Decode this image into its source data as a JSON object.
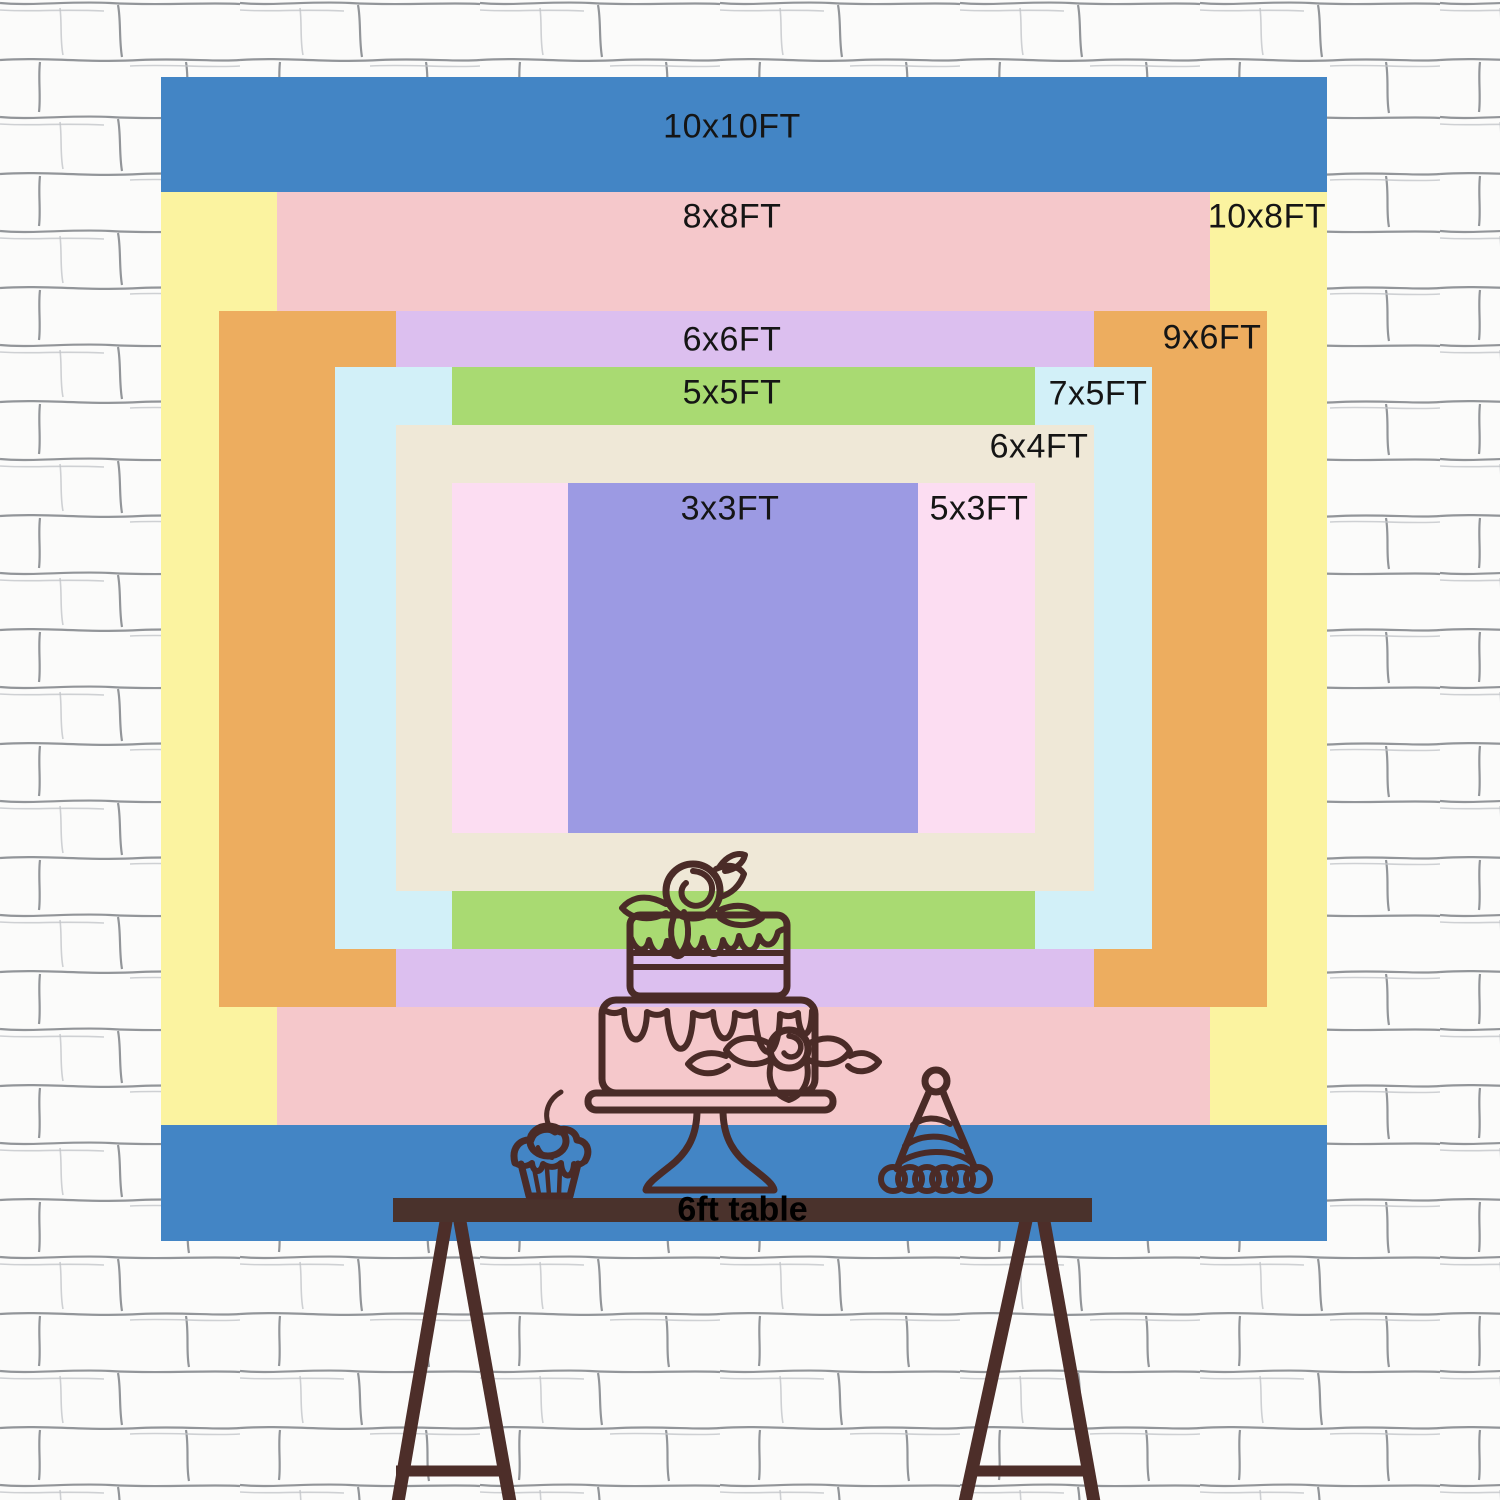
{
  "wall": {
    "bg_color": "#fbfbfa",
    "brick_line_color": "#6e7278",
    "brick_line_faint_color": "#c3c5c9"
  },
  "sizes": [
    {
      "id": "10x10ft",
      "label": "10x10FT",
      "color": "#4385C5",
      "rect": [
        161,
        77,
        1166,
        1164
      ],
      "label_pos": [
        732,
        127
      ]
    },
    {
      "id": "10x8ft",
      "label": "10x8FT",
      "color": "#FBF3A0",
      "rect": [
        161,
        192,
        1166,
        933
      ],
      "label_pos": [
        1267,
        217
      ]
    },
    {
      "id": "8x8ft",
      "label": "8x8FT",
      "color": "#F5C8CB",
      "rect": [
        277,
        192,
        933,
        933
      ],
      "label_pos": [
        732,
        217
      ]
    },
    {
      "id": "9x6ft",
      "label": "9x6FT",
      "color": "#EDAD5F",
      "rect": [
        219,
        311,
        1048,
        696
      ],
      "label_pos": [
        1212,
        338
      ]
    },
    {
      "id": "6x6ft",
      "label": "6x6FT",
      "color": "#DCBFEF",
      "rect": [
        396,
        311,
        698,
        696
      ],
      "label_pos": [
        732,
        340
      ]
    },
    {
      "id": "7x5ft",
      "label": "7x5FT",
      "color": "#D2F0F8",
      "rect": [
        335,
        367,
        817,
        582
      ],
      "label_pos": [
        1098,
        394
      ]
    },
    {
      "id": "5x5ft",
      "label": "5x5FT",
      "color": "#A9DA72",
      "rect": [
        452,
        367,
        583,
        582
      ],
      "label_pos": [
        732,
        393
      ]
    },
    {
      "id": "6x4ft",
      "label": "6x4FT",
      "color": "#EFE8D7",
      "rect": [
        396,
        425,
        698,
        466
      ],
      "label_pos": [
        1039,
        447
      ]
    },
    {
      "id": "5x3ft",
      "label": "5x3FT",
      "color": "#FCDDF2",
      "rect": [
        452,
        483,
        583,
        350
      ],
      "label_pos": [
        979,
        509
      ]
    },
    {
      "id": "3x3ft",
      "label": "3x3FT",
      "color": "#9C9AE3",
      "rect": [
        568,
        483,
        350,
        350
      ],
      "label_pos": [
        730,
        509
      ]
    }
  ],
  "label_text_color": "#151515",
  "table": {
    "label": "6ft table",
    "top_color": "#4A322C",
    "leg_color": "#4D2E29",
    "label_color": "#000000"
  },
  "decor": {
    "line_color": "#4A2B27",
    "items": [
      "cupcake-with-cherry",
      "two-tier-cake-on-stand",
      "party-hat"
    ]
  }
}
